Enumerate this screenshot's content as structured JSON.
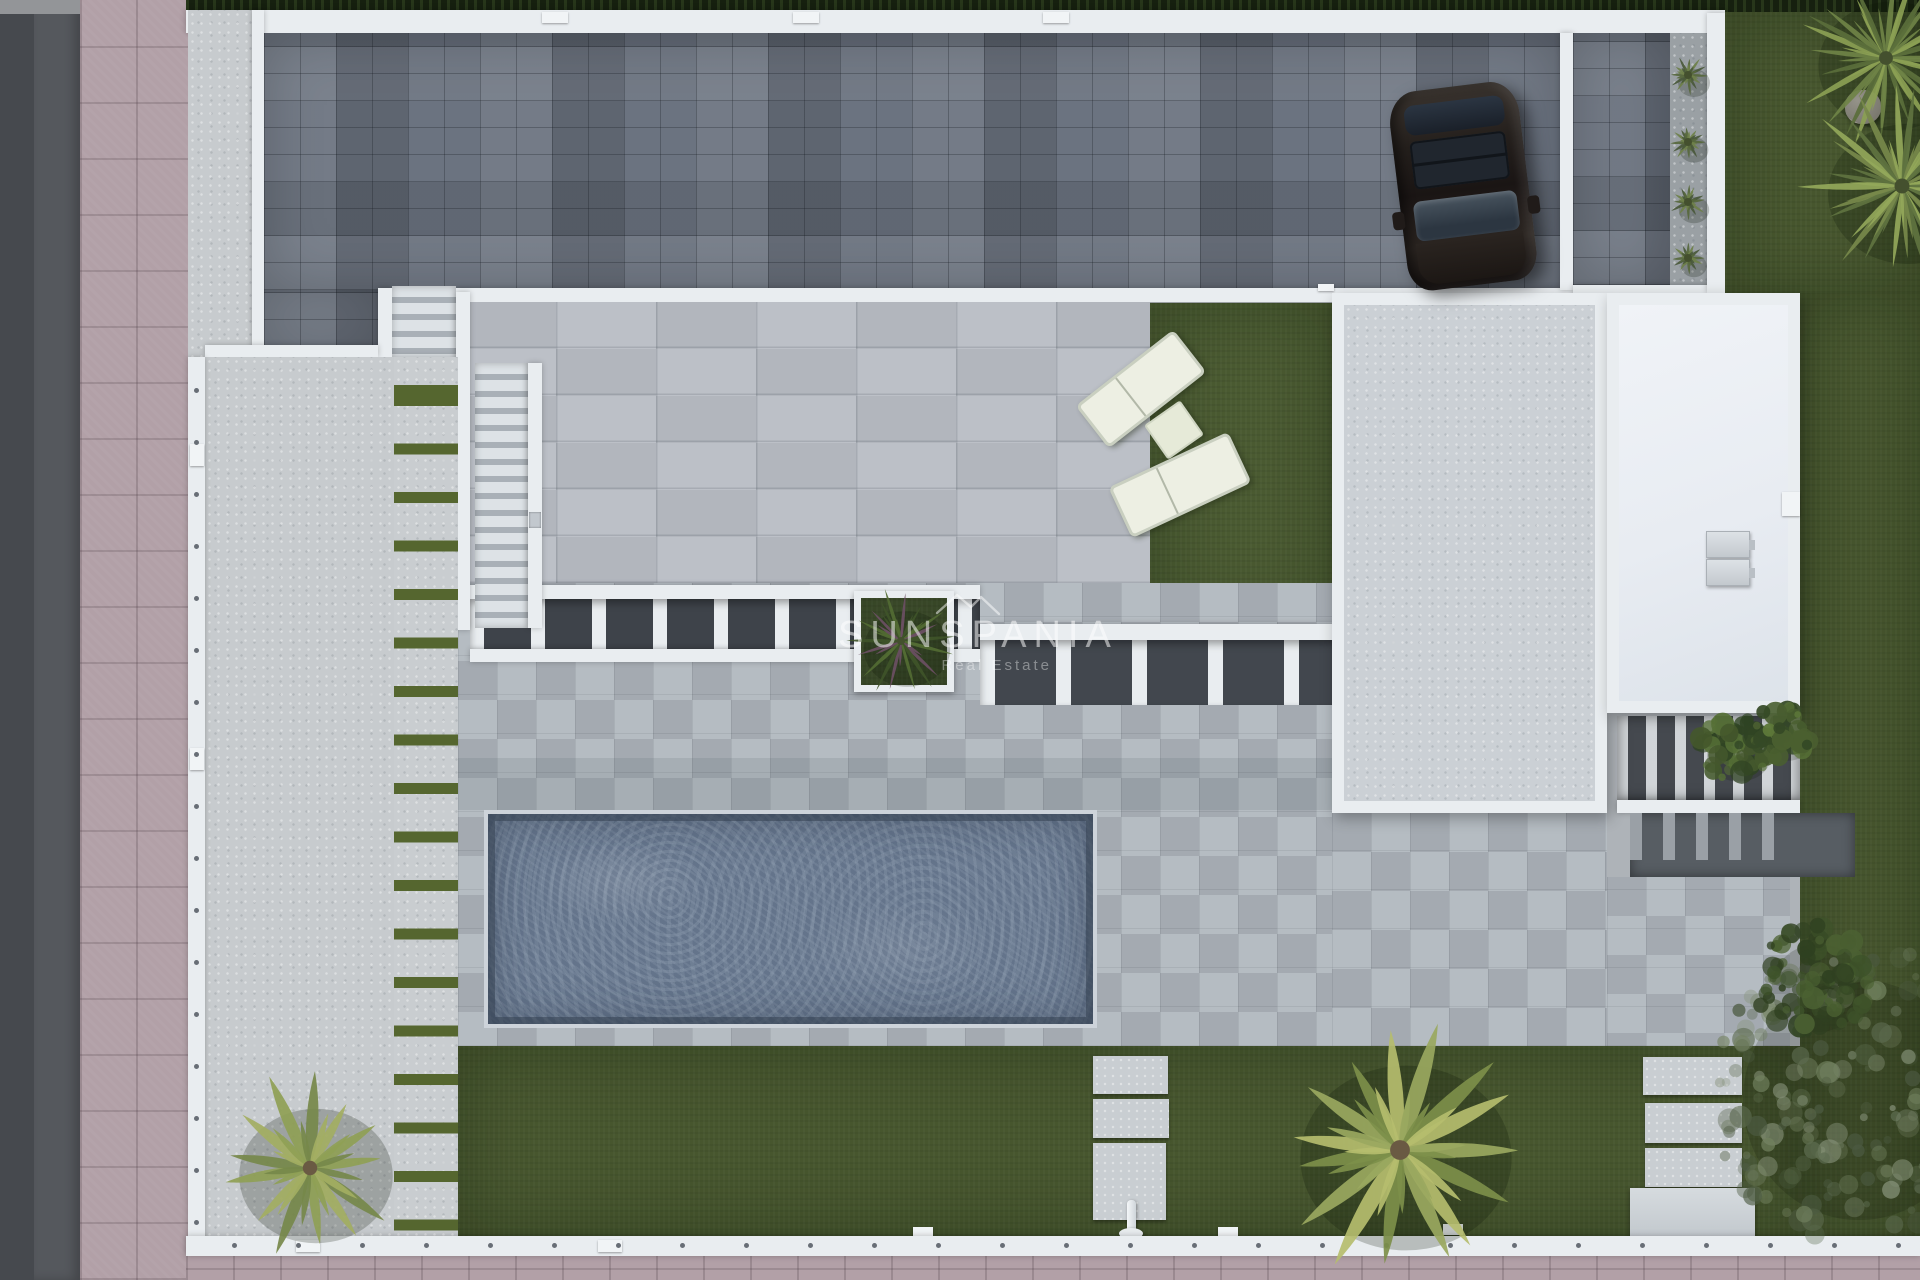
{
  "meta": {
    "type": "3d-aerial-render",
    "subject": "Top-down architectural render of a modern villa plot with driveway, parked SUV, terrace, pergola, swimming pool, lawns and palm trees"
  },
  "watermark": {
    "brand": "SUNSPANIA",
    "tagline": "Real Estate",
    "logo": "roofline-logo"
  },
  "palette": {
    "road": "#55585d",
    "road2": "#46494e",
    "roadtop": "#939598",
    "pink": "#b2a0a7",
    "pinkjoint": "#9c8a91",
    "wall": "#e9edf0",
    "concrete": "#c7cbce",
    "stripegreen": "#55662f",
    "pav": "#6b7380",
    "pavdark": "#565e6a",
    "pavlight": "#7e8793",
    "hedge": "#16200f",
    "terrace": "#b8bdc4",
    "lawn": "#47562e",
    "lawn2": "#4a5a31",
    "deck": "#aeb5bc",
    "water": "#64748b",
    "roofspeck": "#cbd0d5",
    "roofwhite": "#e8ecf2",
    "grate": "#45494f",
    "grate2": "#575d63",
    "cushion": "#edefe3",
    "gravel": "#9aa0a4"
  },
  "scene": {
    "inventory": [
      "asphalt road",
      "pink tiled sidewalk",
      "perimeter white wall",
      "dark paver driveway",
      "parked dark SUV",
      "side paver patio with agave planter strip",
      "top-right lawn with yucca palms and rock",
      "main tiled terrace",
      "two staircases",
      "striped grass parking strip",
      "concrete side pad with palm",
      "artificial lawn with two sun loungers and side table",
      "slatted pergola with square planter",
      "villa textured roof",
      "garage white roof with two AC units",
      "ventilation grate patio with plants",
      "rectangular swimming pool",
      "checkered pool deck",
      "bottom lawn",
      "stepping stone paths",
      "outdoor shower",
      "planter box",
      "large palm tree",
      "olive tree",
      "SUNSPANIA watermark"
    ],
    "palms": [
      {
        "name": "palm-tree-bottom-left",
        "cx": 310,
        "cy": 1168,
        "r": 96,
        "fronds": 13,
        "thin": false,
        "seed": 7,
        "colors": [
          "#8fa055",
          "#76884a",
          "#a3ae62"
        ]
      },
      {
        "name": "palm-tree-bottom-center",
        "cx": 1400,
        "cy": 1150,
        "r": 132,
        "fronds": 15,
        "thin": false,
        "seed": 11,
        "colors": [
          "#9aa85f",
          "#7d8f4a",
          "#b5bd6e"
        ]
      },
      {
        "name": "yucca-palm-top-right-1",
        "cx": 1886,
        "cy": 58,
        "r": 92,
        "fronds": 24,
        "thin": true,
        "seed": 3,
        "colors": [
          "#6f8347",
          "#8ba054",
          "#5a6e3b"
        ]
      },
      {
        "name": "yucca-palm-top-right-2",
        "cx": 1902,
        "cy": 186,
        "r": 100,
        "fronds": 26,
        "thin": true,
        "seed": 5,
        "colors": [
          "#77894b",
          "#93a75a",
          "#5f7340"
        ]
      },
      {
        "name": "pergola-planter-plant",
        "cx": 901,
        "cy": 641,
        "r": 54,
        "fronds": 18,
        "thin": true,
        "seed": 9,
        "colors": [
          "#3f5429",
          "#526b33",
          "#6b4f63"
        ]
      }
    ],
    "miniplants": [
      {
        "cx": 1688,
        "cy": 75,
        "r": 20,
        "seed": 31
      },
      {
        "cx": 1688,
        "cy": 142,
        "r": 18,
        "seed": 33
      },
      {
        "cx": 1688,
        "cy": 202,
        "r": 19,
        "seed": 35
      },
      {
        "cx": 1688,
        "cy": 258,
        "r": 16,
        "seed": 37
      }
    ],
    "miniplantColors": [
      "#57683d",
      "#6e8049",
      "#49583a"
    ],
    "bushes": [
      {
        "name": "olive-tree-bottom-right",
        "cx": 1853,
        "cy": 1092,
        "rx": 145,
        "ry": 150,
        "n": 190,
        "seed": 21,
        "a0": 0.22,
        "a1": 0.75,
        "colors": [
          "#5d6c50",
          "#72815f",
          "#87937a",
          "#4c5a41"
        ]
      },
      {
        "name": "shrub-right-lawn",
        "cx": 1812,
        "cy": 980,
        "rx": 58,
        "ry": 55,
        "n": 85,
        "seed": 13,
        "a0": 0.5,
        "a1": 0.95,
        "colors": [
          "#2f4020",
          "#3d5229",
          "#4b6132"
        ]
      },
      {
        "name": "grate-plants-1",
        "cx": 1733,
        "cy": 748,
        "rx": 40,
        "ry": 32,
        "n": 60,
        "seed": 17,
        "a0": 0.6,
        "a1": 1,
        "colors": [
          "#2f4323",
          "#44582c",
          "#567036"
        ]
      },
      {
        "name": "grate-plants-2",
        "cx": 1782,
        "cy": 732,
        "rx": 30,
        "ry": 26,
        "n": 45,
        "seed": 19,
        "a0": 0.6,
        "a1": 1,
        "colors": [
          "#354926",
          "#4a5f30",
          "#5d7839"
        ]
      }
    ],
    "posts": {
      "left_wall": {
        "x": 194,
        "y0": 388,
        "y1": 1230,
        "step": 52
      },
      "bottom_wall": {
        "y": 1243,
        "x0": 232,
        "x1": 1900,
        "step": 64
      }
    },
    "car": {
      "type": "SUV",
      "body_color": "#26211f",
      "glass_color": "#3a4450",
      "rotation_deg": -7
    },
    "pool": {
      "shape": "rectangular",
      "water_color": "#64748b",
      "ripples": "light"
    },
    "loungers": {
      "count": 2,
      "cushion_color": "#edefe3",
      "side_table": true
    },
    "rock": {
      "x": 1845,
      "y": 90
    }
  }
}
